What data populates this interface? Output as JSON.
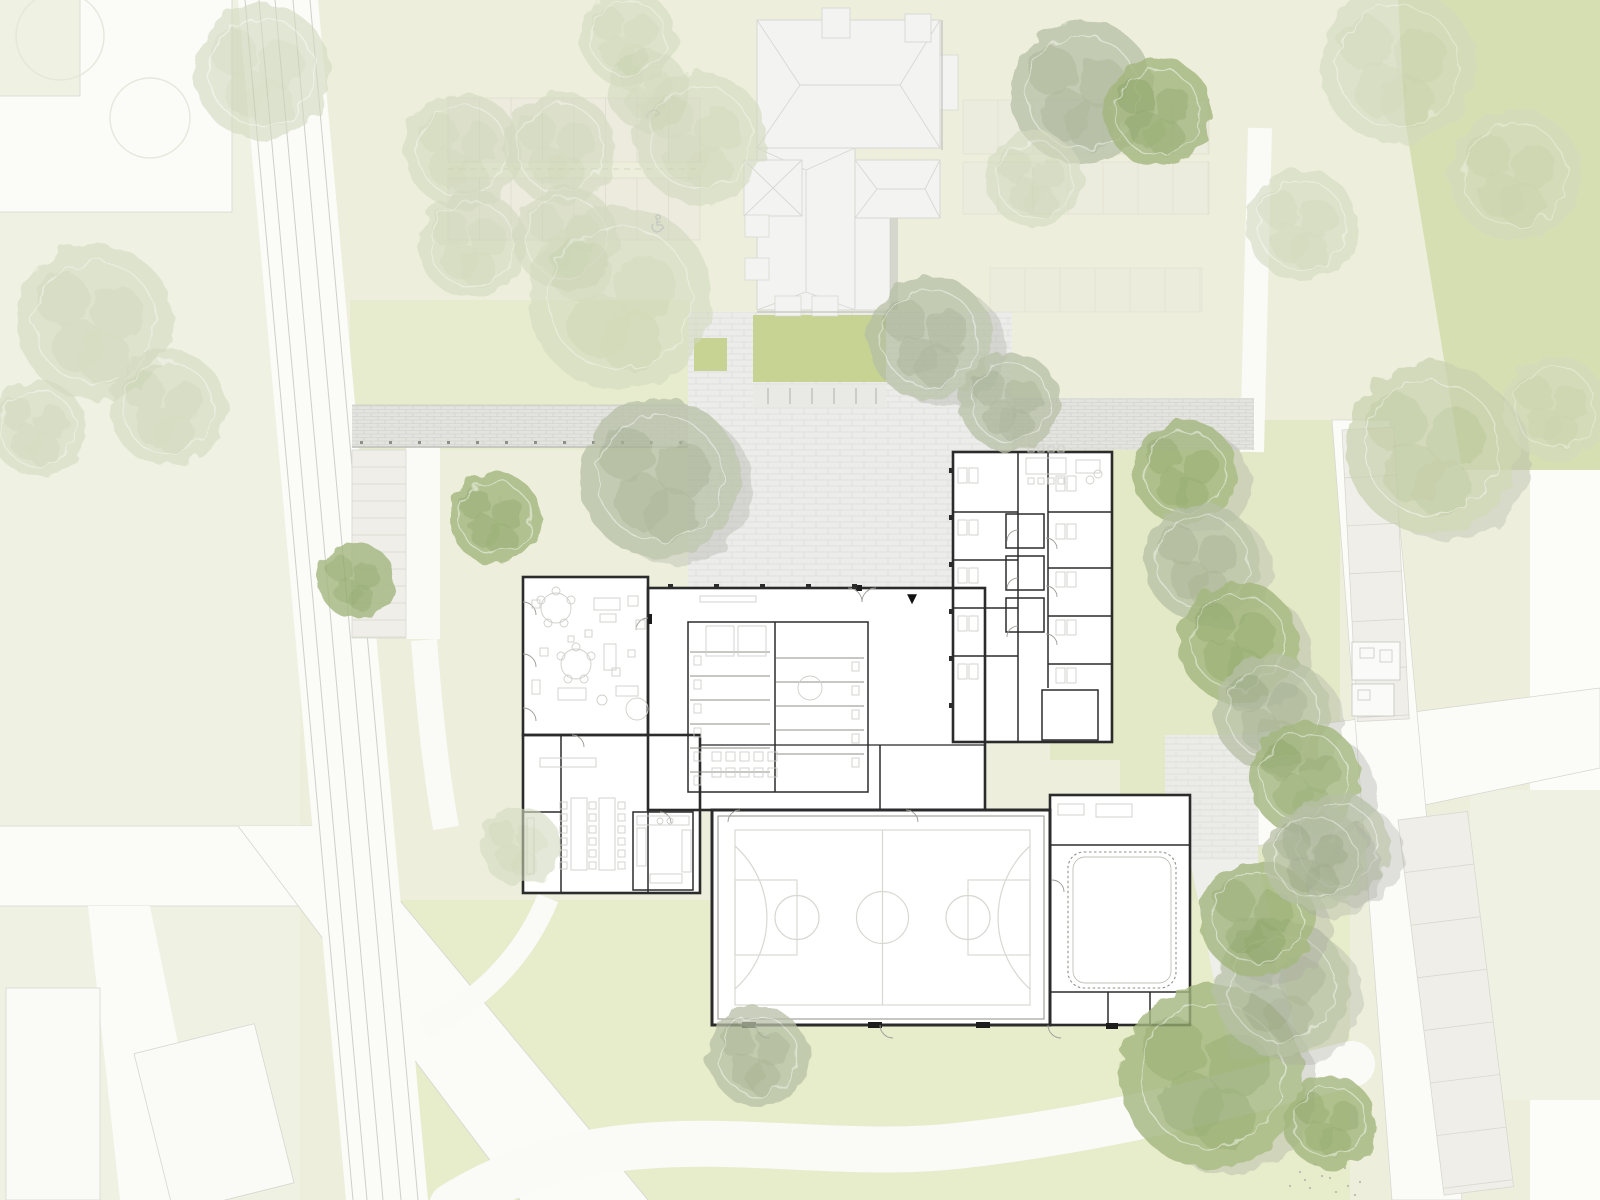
{
  "markers": {
    "entrance_glyph": "▼"
  },
  "colors": {
    "paper": "#fcfcf9",
    "grass-left": "#eff1e3",
    "grass-campus": "#edefdc",
    "grass-mid": "#e7ecce",
    "grass-east": "#e3e9c6",
    "grass-south": "#e7ecca",
    "grass-deep": "#d6dfb2",
    "grass-square": "#c6d393",
    "road-white": "#fbfbf8",
    "road-edge": "#d6d6d0",
    "rail-line": "#cfcfc9",
    "plaza": "#ececea",
    "plaza-line": "#dcdcd7",
    "band": "#e3e3df",
    "band-line": "#cdcdc8",
    "canopy": "#d1d1ce",
    "canopy-edge": "#a0a09b",
    "stall-fill": "#efeee8",
    "stall-line": "#d8d8d1",
    "stall-faint-fill": "#ecebdf",
    "stall-faint-line": "#dedacc",
    "exist-fill": "#f3f3f1",
    "exist-line": "#d7d7d3",
    "exist-shadow": "#c6c6c2",
    "wall": "#2b2b2b",
    "wall-light": "#8f8f8a",
    "furn": "#cfcfca",
    "court": "#d8d8d3",
    "door": "#9a9a95",
    "tread": "#a5a5a0",
    "marker": "#111111",
    "icon-blue": "#adb4c6",
    "shed-fill": "#fafaf8",
    "plot-fill": "#fafaf7",
    "tree-shadow": "#a8aba1",
    "white-path": "#fafaf7"
  },
  "site": {
    "tree_variants": {
      "green": {
        "b": "#a3b77e",
        "d": "#87a05e",
        "o": 0.8
      },
      "gray": {
        "b": "#b7c0a6",
        "d": "#9aa687",
        "o": 0.75
      },
      "pale": {
        "b": "#c8d2ae",
        "d": "#b3c091",
        "o": 0.7
      },
      "faint": {
        "b": "#d3dabf",
        "d": "#c3cda9",
        "o": 0.6
      },
      "ring": {
        "b": "#e3e6d8",
        "d": "#e3e6d8",
        "o": 0.9
      }
    },
    "trees": [
      [
        60,
        36,
        44,
        "ring",
        0
      ],
      [
        150,
        118,
        40,
        "ring",
        0
      ],
      [
        262,
        72,
        68,
        "faint",
        0
      ],
      [
        95,
        322,
        78,
        "faint",
        0
      ],
      [
        168,
        408,
        58,
        "faint",
        0
      ],
      [
        38,
        428,
        48,
        "faint",
        0
      ],
      [
        462,
        150,
        58,
        "faint",
        0
      ],
      [
        560,
        148,
        56,
        "faint",
        0
      ],
      [
        472,
        244,
        54,
        "faint",
        0
      ],
      [
        566,
        238,
        52,
        "faint",
        0
      ],
      [
        648,
        90,
        40,
        "faint",
        0
      ],
      [
        700,
        138,
        66,
        "faint",
        0
      ],
      [
        628,
        38,
        48,
        "faint",
        0
      ],
      [
        620,
        298,
        92,
        "faint",
        0
      ],
      [
        660,
        478,
        80,
        "gray",
        1
      ],
      [
        495,
        518,
        46,
        "green",
        0
      ],
      [
        356,
        580,
        38,
        "green",
        0
      ],
      [
        930,
        338,
        62,
        "gray",
        1
      ],
      [
        1010,
        402,
        50,
        "gray",
        0
      ],
      [
        1082,
        92,
        72,
        "gray",
        0
      ],
      [
        1158,
        112,
        54,
        "green",
        0
      ],
      [
        1035,
        180,
        48,
        "faint",
        0
      ],
      [
        1398,
        66,
        78,
        "faint",
        0
      ],
      [
        1515,
        175,
        66,
        "faint",
        0
      ],
      [
        1302,
        225,
        56,
        "faint",
        0
      ],
      [
        1432,
        448,
        86,
        "pale",
        1
      ],
      [
        1555,
        408,
        52,
        "faint",
        0
      ],
      [
        1185,
        472,
        52,
        "green",
        1
      ],
      [
        1202,
        562,
        58,
        "gray",
        1
      ],
      [
        1238,
        642,
        60,
        "green",
        1
      ],
      [
        1272,
        712,
        58,
        "gray",
        1
      ],
      [
        1305,
        778,
        56,
        "green",
        1
      ],
      [
        1338,
        845,
        52,
        "gray",
        1
      ],
      [
        758,
        1056,
        50,
        "gray",
        0
      ],
      [
        520,
        846,
        40,
        "faint",
        0
      ],
      [
        1212,
        1076,
        92,
        "green",
        1
      ],
      [
        1282,
        988,
        68,
        "gray",
        1
      ],
      [
        1258,
        918,
        58,
        "green",
        1
      ],
      [
        1315,
        858,
        52,
        "gray",
        1
      ],
      [
        1330,
        1122,
        46,
        "green",
        0
      ]
    ],
    "stall_rows": [
      {
        "x": 448,
        "y": 98,
        "w": 252,
        "h": 64,
        "step": 31.5,
        "dir": "v",
        "rot": 0,
        "fill": "stall-faint-fill",
        "line": "stall-faint-line",
        "op": 0.85
      },
      {
        "x": 448,
        "y": 178,
        "w": 252,
        "h": 62,
        "step": 31.5,
        "dir": "v",
        "rot": 0,
        "fill": "stall-faint-fill",
        "line": "stall-faint-line",
        "op": 0.85
      },
      {
        "x": 963,
        "y": 100,
        "w": 246,
        "h": 54,
        "step": 35,
        "dir": "v",
        "rot": 0,
        "fill": "stall-faint-fill",
        "line": "stall-faint-line",
        "op": 0.7
      },
      {
        "x": 963,
        "y": 162,
        "w": 246,
        "h": 52,
        "step": 35,
        "dir": "v",
        "rot": 0,
        "fill": "stall-faint-fill",
        "line": "stall-faint-line",
        "op": 0.7
      },
      {
        "x": 990,
        "y": 268,
        "w": 212,
        "h": 44,
        "step": 35,
        "dir": "v",
        "rot": 0,
        "fill": "stall-faint-fill",
        "line": "stall-faint-line",
        "op": 0.6
      },
      {
        "x": 352,
        "y": 450,
        "w": 54,
        "h": 188,
        "step": 17,
        "dir": "h",
        "rot": 0,
        "fill": "stall-fill",
        "line": "stall-line",
        "op": 1
      },
      {
        "x": 1342,
        "y": 430,
        "w": 52,
        "h": 292,
        "step": 48,
        "dir": "h",
        "rot": -3,
        "fill": "stall-fill",
        "line": "stall-line",
        "op": 1
      },
      {
        "x": 1398,
        "y": 820,
        "w": 70,
        "h": 378,
        "step": 53,
        "dir": "h",
        "rot": -7,
        "fill": "stall-fill",
        "line": "stall-line",
        "op": 1
      },
      {
        "x": 693,
        "y": 554,
        "w": 165,
        "h": 26,
        "step": 5,
        "dir": "v",
        "rot": 0,
        "fill": "none",
        "line": "tread",
        "op": 1
      },
      {
        "x": 1044,
        "y": 692,
        "w": 52,
        "h": 46,
        "step": 4.6,
        "dir": "v",
        "rot": 0,
        "fill": "none",
        "line": "tread",
        "op": 1
      },
      {
        "x": 1128,
        "y": 962,
        "w": 24,
        "h": 30,
        "step": 4,
        "dir": "v",
        "rot": 0,
        "fill": "none",
        "line": "tread",
        "op": 1
      },
      {
        "x": 1156,
        "y": 996,
        "w": 36,
        "h": 14,
        "step": 3.5,
        "dir": "v",
        "rot": 0,
        "fill": "none",
        "line": "tread",
        "op": 1
      },
      {
        "x": 1106,
        "y": 998,
        "w": 28,
        "h": 12,
        "step": 4,
        "dir": "v",
        "rot": 0,
        "fill": "none",
        "line": "tread",
        "op": 1
      }
    ],
    "furniture": [
      [
        "c",
        556,
        608,
        15
      ],
      [
        "c",
        541,
        600,
        4
      ],
      [
        "c",
        556,
        591,
        4
      ],
      [
        "c",
        571,
        600,
        4
      ],
      [
        "c",
        548,
        623,
        4
      ],
      [
        "c",
        564,
        623,
        4
      ],
      [
        "c",
        576,
        664,
        15
      ],
      [
        "c",
        561,
        656,
        4
      ],
      [
        "c",
        576,
        647,
        4
      ],
      [
        "c",
        591,
        656,
        4
      ],
      [
        "c",
        568,
        679,
        4
      ],
      [
        "c",
        584,
        679,
        4
      ],
      [
        "r",
        594,
        598,
        26,
        12
      ],
      [
        "r",
        600,
        614,
        16,
        8
      ],
      [
        "r",
        604,
        644,
        12,
        26
      ],
      [
        "r",
        628,
        596,
        10,
        10
      ],
      [
        "r",
        636,
        620,
        9,
        9
      ],
      [
        "r",
        558,
        688,
        28,
        12
      ],
      [
        "c",
        602,
        700,
        5
      ],
      [
        "r",
        616,
        686,
        22,
        10
      ],
      [
        "c",
        637,
        709,
        11
      ],
      [
        "r",
        585,
        630,
        7,
        7
      ],
      [
        "r",
        612,
        668,
        8,
        8
      ],
      [
        "r",
        540,
        648,
        8,
        8
      ],
      [
        "r",
        628,
        650,
        7,
        7
      ],
      [
        "r",
        568,
        636,
        6,
        6
      ],
      [
        "r",
        532,
        600,
        8,
        8
      ],
      [
        "r",
        532,
        680,
        8,
        14
      ],
      [
        "r",
        571,
        798,
        16,
        72
      ],
      [
        "r",
        599,
        798,
        16,
        72
      ],
      [
        "r",
        540,
        758,
        56,
        9
      ],
      [
        "r",
        637,
        816,
        52,
        9
      ],
      [
        "r",
        637,
        828,
        9,
        38
      ],
      [
        "r",
        682,
        830,
        9,
        42
      ],
      [
        "r",
        650,
        874,
        32,
        9
      ],
      [
        "c",
        660,
        821,
        3
      ],
      [
        "c",
        670,
        821,
        3
      ],
      [
        "c",
        810,
        688,
        12
      ],
      [
        "r",
        700,
        596,
        56,
        6
      ],
      [
        "r",
        1026,
        458,
        40,
        16
      ],
      [
        "r",
        1076,
        460,
        24,
        13
      ],
      [
        "c",
        1090,
        480,
        4
      ],
      [
        "c",
        1098,
        474,
        4
      ],
      [
        "r",
        1058,
        804,
        26,
        11
      ],
      [
        "r",
        1096,
        804,
        36,
        13
      ],
      [
        "r",
        527,
        818,
        7,
        56
      ],
      [
        "r",
        706,
        626,
        28,
        30
      ],
      [
        "r",
        738,
        626,
        28,
        30
      ],
      [
        "r",
        1360,
        648,
        14,
        10
      ],
      [
        "r",
        1380,
        650,
        12,
        12
      ],
      [
        "r",
        1358,
        690,
        12,
        10
      ]
    ],
    "chair_rows": [
      {
        "x": 560,
        "y": 802,
        "n": 6,
        "dx": 0,
        "dy": 12,
        "s": 7,
        "f": "furn"
      },
      {
        "x": 589,
        "y": 802,
        "n": 6,
        "dx": 0,
        "dy": 12,
        "s": 7,
        "f": "furn"
      },
      {
        "x": 618,
        "y": 802,
        "n": 6,
        "dx": 0,
        "dy": 12,
        "s": 7,
        "f": "furn"
      },
      {
        "x": 712,
        "y": 752,
        "n": 5,
        "dx": 14,
        "dy": 0,
        "s": 9,
        "f": "furn"
      },
      {
        "x": 712,
        "y": 768,
        "n": 5,
        "dx": 14,
        "dy": 0,
        "s": 9,
        "f": "furn"
      },
      {
        "x": 1028,
        "y": 446,
        "n": 4,
        "dx": 10,
        "dy": 0,
        "s": 6,
        "f": "furn"
      },
      {
        "x": 1028,
        "y": 478,
        "n": 4,
        "dx": 10,
        "dy": 0,
        "s": 6,
        "f": "furn"
      },
      {
        "x": 668,
        "y": 584,
        "n": 5,
        "dx": 46,
        "dy": 0,
        "s": 5,
        "f": "wall"
      },
      {
        "x": 949,
        "y": 468,
        "n": 6,
        "dx": 0,
        "dy": 47,
        "s": 5,
        "f": "wall"
      },
      {
        "x": 360,
        "y": 441,
        "n": 12,
        "dx": 29,
        "dy": 0,
        "s": 3,
        "f": "wall-light"
      }
    ],
    "desk_clusters": [
      [
        958,
        468
      ],
      [
        958,
        520
      ],
      [
        958,
        568
      ],
      [
        958,
        616
      ],
      [
        958,
        664
      ],
      [
        1056,
        476
      ],
      [
        1056,
        524
      ],
      [
        1056,
        572
      ],
      [
        1056,
        620
      ],
      [
        1056,
        668
      ]
    ],
    "wc": {
      "left": {
        "x1": 690,
        "x2": 770,
        "fx": 694,
        "ys": [
          652,
          676,
          700,
          724,
          748,
          772
        ]
      },
      "right": {
        "x1": 776,
        "x2": 864,
        "fx": 852,
        "ys": [
          658,
          682,
          706,
          730,
          754
        ]
      }
    }
  }
}
